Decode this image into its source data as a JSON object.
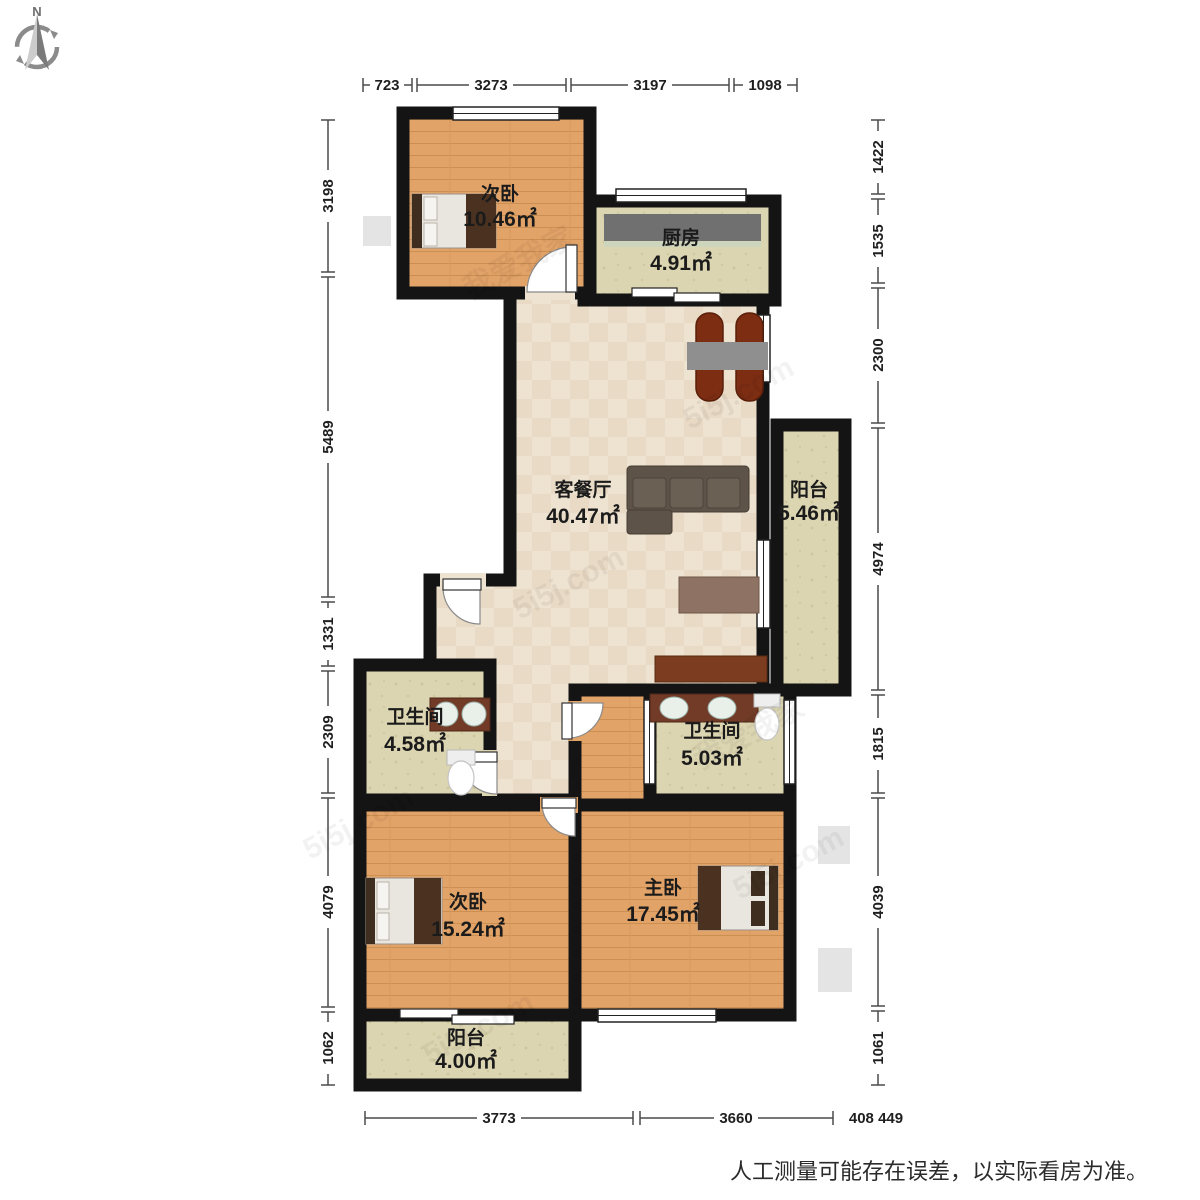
{
  "compass": {
    "north_label": "N"
  },
  "watermarks": {
    "site": "5i5j.com",
    "brand": "我爱我家"
  },
  "disclaimer": "人工测量可能存在误差，以实际看房为准。",
  "dimensions": {
    "top": [
      "723",
      "3273",
      "3197",
      "1098"
    ],
    "left": [
      "3198",
      "5489",
      "1331",
      "2309",
      "4079",
      "1062"
    ],
    "right": [
      "1422",
      "1535",
      "2300",
      "4974",
      "1815",
      "4039",
      "1061"
    ],
    "bottom": [
      "3773",
      "3660",
      "408 449"
    ]
  },
  "rooms": [
    {
      "name": "次卧",
      "area": "10.46㎡"
    },
    {
      "name": "厨房",
      "area": "4.91㎡"
    },
    {
      "name": "客餐厅",
      "area": "40.47㎡"
    },
    {
      "name": "阳台",
      "area": "5.46㎡"
    },
    {
      "name": "卫生间",
      "area": "4.58㎡"
    },
    {
      "name": "卫生间",
      "area": "5.03㎡"
    },
    {
      "name": "次卧",
      "area": "15.24㎡"
    },
    {
      "name": "主卧",
      "area": "17.45㎡"
    },
    {
      "name": "阳台",
      "area": "4.00㎡"
    }
  ],
  "colors": {
    "wall": "#141414",
    "wood_floor": "#e2a368",
    "tile_floor": "#ecdfcd",
    "stone_floor": "#dcd5b1",
    "furniture_wood": "#7c3c1f",
    "dim_text": "#1f1f1f"
  }
}
